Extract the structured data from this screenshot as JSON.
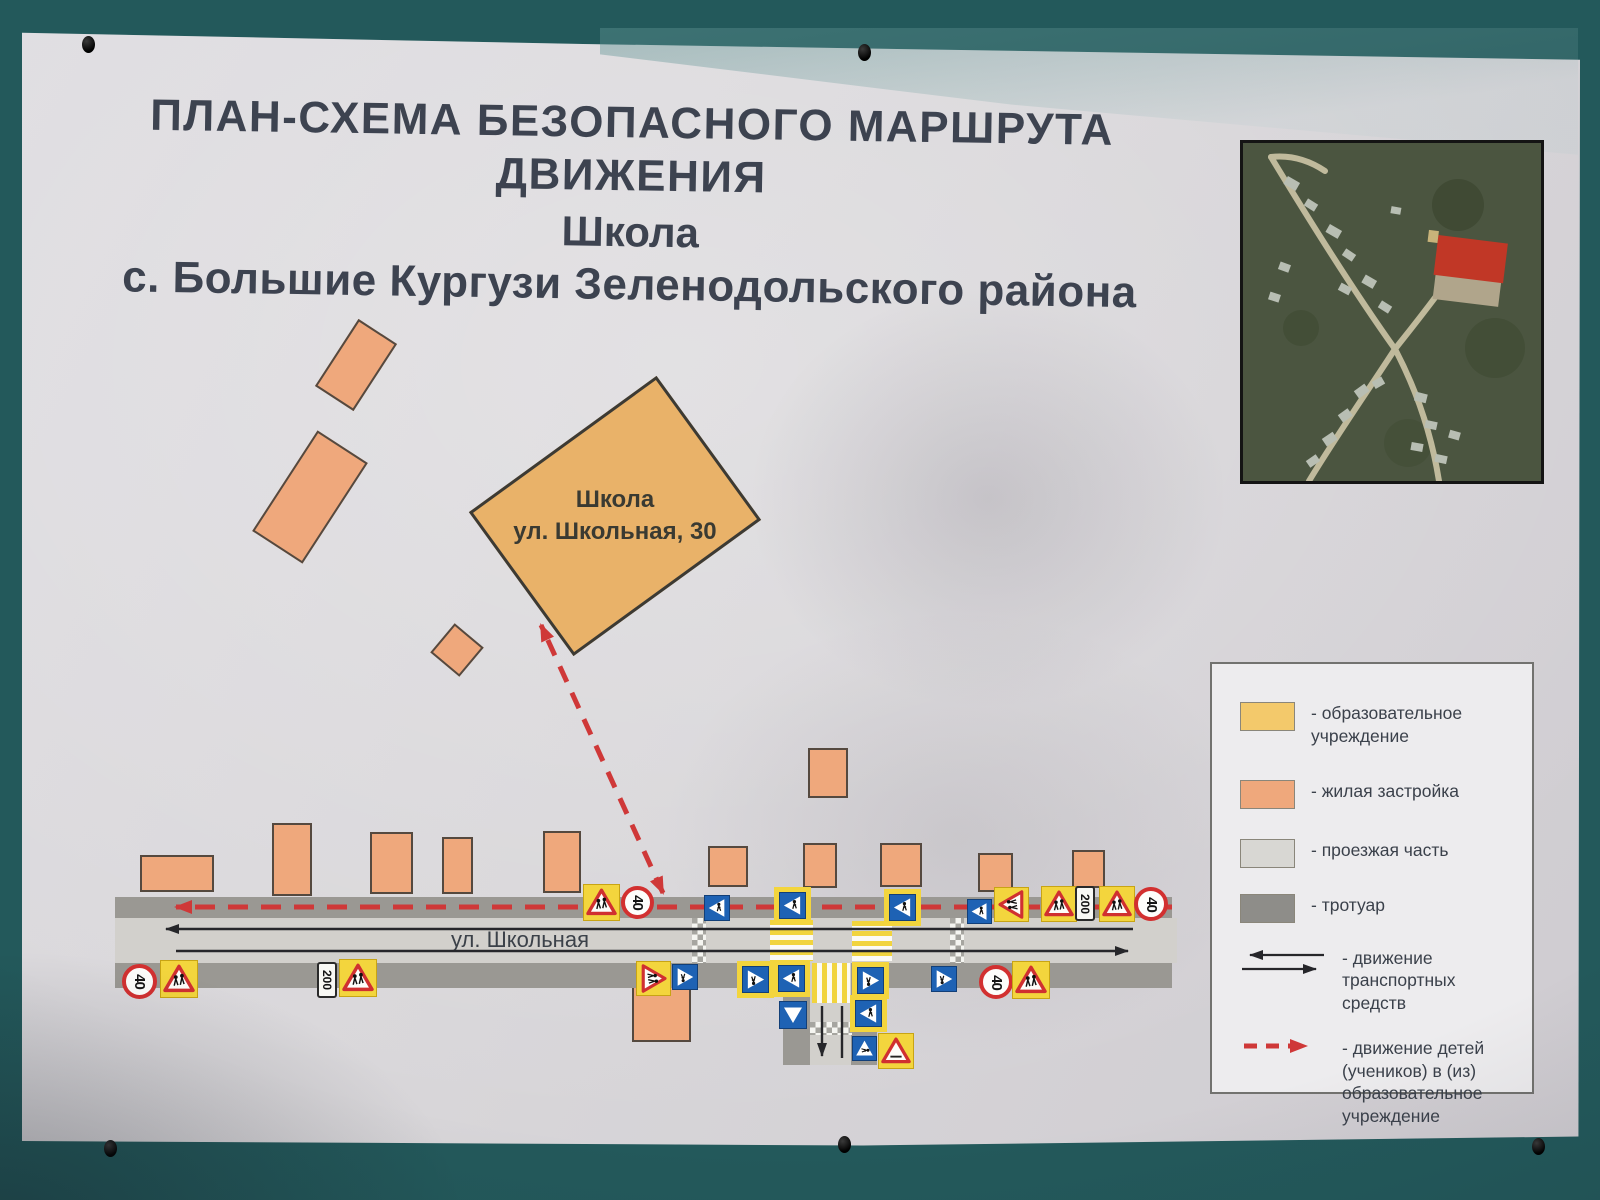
{
  "poster": {
    "title_line1": "ПЛАН-СХЕМА БЕЗОПАСНОГО МАРШРУТА ДВИЖЕНИЯ",
    "title_line2": "Школа",
    "title_line3": "с. Большие Кургузи Зеленодольского района"
  },
  "map": {
    "school_label_line1": "Школа",
    "school_label_line2": "ул. Школьная, 30",
    "street_name": "ул. Школьная",
    "speed_limit_text": "40",
    "distance_plate_text": "200"
  },
  "legend": {
    "items": [
      {
        "label": "- образовательное учреждение"
      },
      {
        "label": "- жилая застройка"
      },
      {
        "label": "- проезжая часть"
      },
      {
        "label": "- тротуар"
      },
      {
        "label": "- движение транспортных средств"
      },
      {
        "label": "- движение детей (учеников) в (из) образовательное учреждение"
      }
    ]
  },
  "colors": {
    "wall_teal": "#2f8285",
    "poster_paper": "#d8d6d9",
    "education_fill": "#e9b269",
    "residential_fill": "#efa87c",
    "roadway_fill": "#d2d0cc",
    "sidewalk_fill": "#9a9893",
    "route_red": "#cf3838",
    "sign_blue": "#1e62b4",
    "sign_yellow": "#f3d53d"
  }
}
